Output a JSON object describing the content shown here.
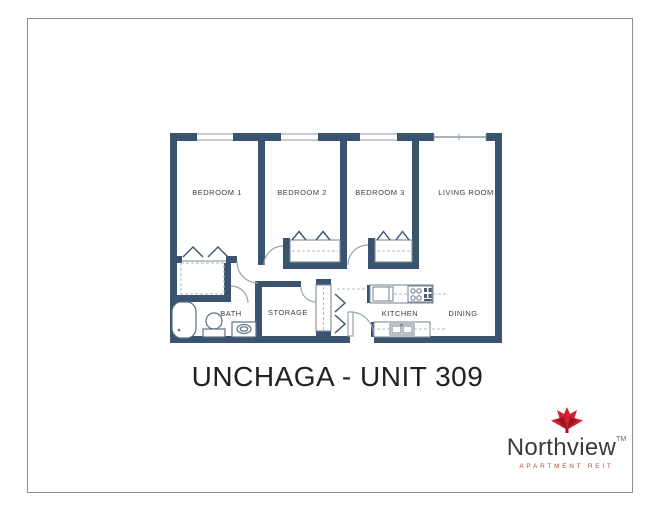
{
  "title": "UNCHAGA - UNIT 309",
  "floor_plan": {
    "wall_color": "#3a536e",
    "rooms": {
      "bedroom1": "BEDROOM 1",
      "bedroom2": "BEDROOM 2",
      "bedroom3": "BEDROOM 3",
      "living": "LIVING ROOM",
      "bath": "BATH",
      "storage": "STORAGE",
      "kitchen": "KITCHEN",
      "dining": "DINING"
    }
  },
  "logo": {
    "brand": "Northview",
    "trademark": "TM",
    "tagline": "APARTMENT REIT",
    "brand_color": "#3b3b3d",
    "tagline_color": "#b5443c",
    "leaf_red": "#cf2130",
    "leaf_dark_red": "#9a161f"
  }
}
